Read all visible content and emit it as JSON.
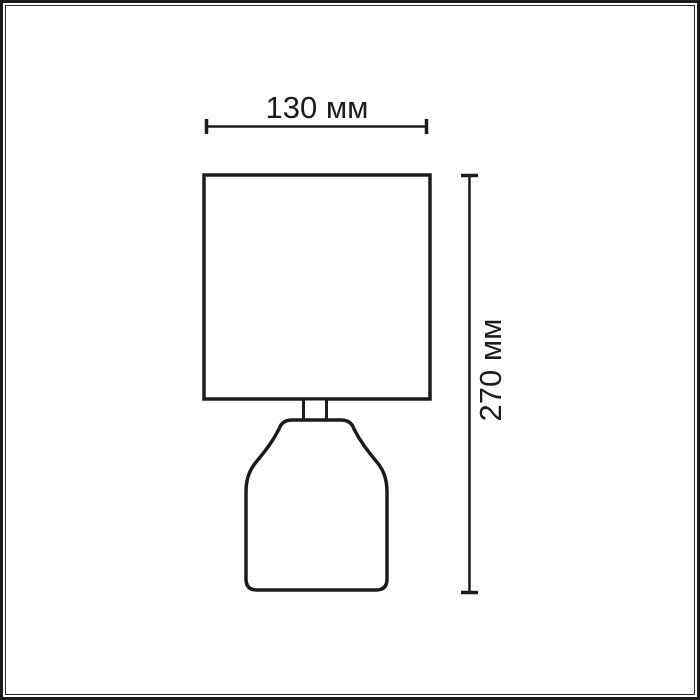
{
  "diagram": {
    "subject": "table-lamp-outline-drawing",
    "width_dimension": {
      "label": "130 мм",
      "value": 130,
      "unit": "мм",
      "orientation": "horizontal",
      "measures": "lampshade width"
    },
    "height_dimension": {
      "label": "270 мм",
      "value": 270,
      "unit": "мм",
      "orientation": "vertical",
      "measures": "total lamp height"
    }
  },
  "colors": {
    "line": "#1c1c1c",
    "background": "#ffffff"
  }
}
